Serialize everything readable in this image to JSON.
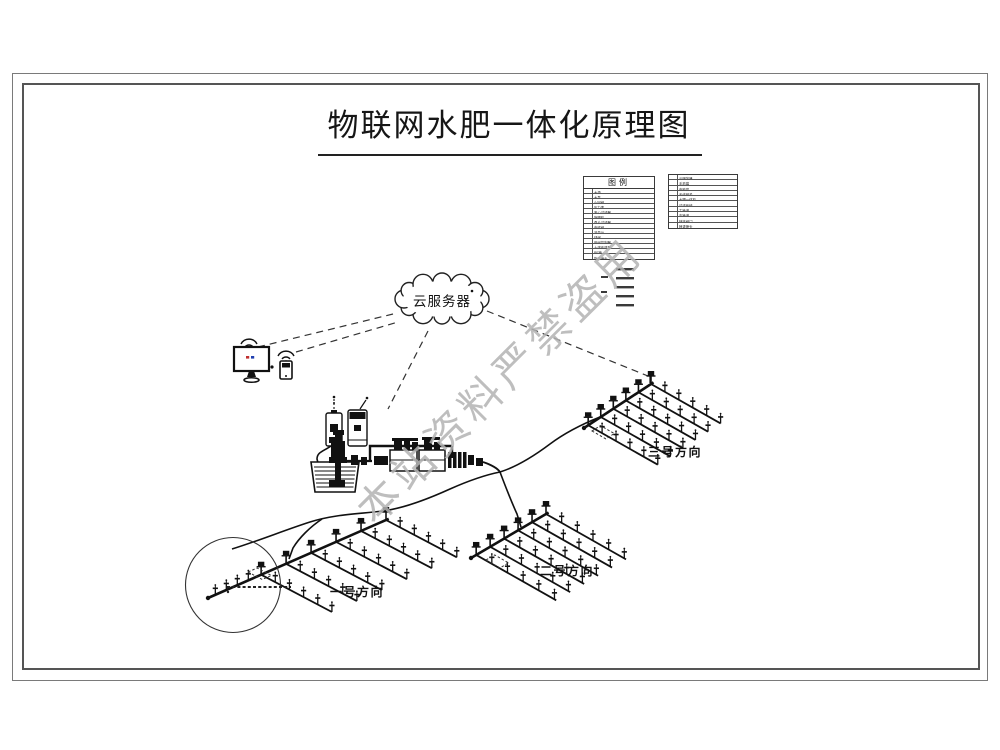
{
  "page": {
    "title": "物联网水肥一体化原理图"
  },
  "watermark": {
    "text": "本站资料严禁盗用",
    "color": "#b3b3b3"
  },
  "cloud": {
    "label": "云服务器"
  },
  "fields": [
    {
      "label": "一号方向"
    },
    {
      "label": "二号方向"
    },
    {
      "label": "三号方向"
    }
  ],
  "legend": {
    "title": "图例",
    "left_rows": [
      {
        "num": "1",
        "label": "水源"
      },
      {
        "num": "2",
        "label": "水泵"
      },
      {
        "num": "3",
        "label": "止回阀"
      },
      {
        "num": "4",
        "label": "压力表"
      },
      {
        "num": "5",
        "label": "离心过滤器"
      },
      {
        "num": "6",
        "label": "施肥机"
      },
      {
        "num": "7",
        "label": "叠片过滤器"
      },
      {
        "num": "8",
        "label": "电磁阀"
      },
      {
        "num": "9",
        "label": "流量计"
      },
      {
        "num": "10",
        "label": "球阀"
      },
      {
        "num": "11",
        "label": "田间控制器"
      },
      {
        "num": "12",
        "label": "土壤传感器"
      },
      {
        "num": "13",
        "label": "PE管"
      },
      {
        "num": "14",
        "label": "旋转喷头"
      }
    ],
    "right_rows": [
      {
        "num": "1",
        "label": "云服务器"
      },
      {
        "num": "2",
        "label": "手机端"
      },
      {
        "num": "3",
        "label": "电脑端"
      },
      {
        "num": "4",
        "label": "无线网关"
      },
      {
        "num": "5",
        "label": "水肥一体机"
      },
      {
        "num": "6",
        "label": "过滤系统"
      },
      {
        "num": "7",
        "label": "主管道"
      },
      {
        "num": "8",
        "label": "支管道"
      },
      {
        "num": "9",
        "label": "快接阀门"
      },
      {
        "num": "10",
        "label": "喷灌喷头"
      }
    ]
  },
  "icons": {
    "cloud": "cloud-server-icon",
    "monitor": "monitor-icon",
    "phone": "smartphone-icon",
    "wifi": "wifi-icon",
    "pump": "pump-icon",
    "basin": "water-basin-icon",
    "sprinkler": "sprinkler-icon"
  },
  "colors": {
    "line": "#111111",
    "frame": "#555555",
    "watermark": "#b3b3b3",
    "background": "#ffffff"
  }
}
